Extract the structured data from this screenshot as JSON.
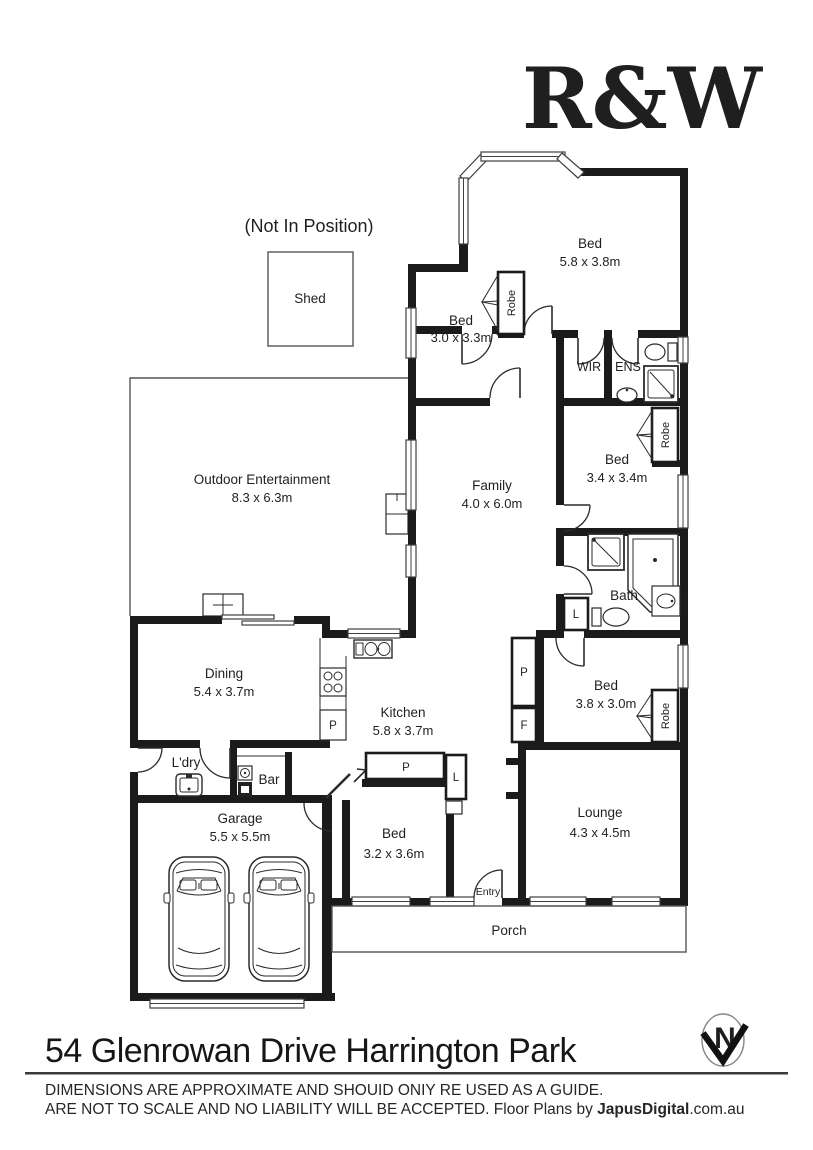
{
  "logo": {
    "text": "R&W",
    "color": "#E4032E"
  },
  "notes": {
    "not_in_position": "(Not In Position)"
  },
  "rooms": {
    "shed": {
      "name": "Shed"
    },
    "bed_master": {
      "name": "Bed",
      "dims": "5.8 x 3.8m"
    },
    "bed2": {
      "name": "Bed",
      "dims": "3.0 x 3.3m"
    },
    "bed3": {
      "name": "Bed",
      "dims": "3.4 x 3.4m"
    },
    "bed4": {
      "name": "Bed",
      "dims": "3.8 x 3.0m"
    },
    "bed5": {
      "name": "Bed",
      "dims": "3.2 x 3.6m"
    },
    "family": {
      "name": "Family",
      "dims": "4.0 x 6.0m"
    },
    "outdoor": {
      "name": "Outdoor Entertainment",
      "dims": "8.3 x 6.3m"
    },
    "dining": {
      "name": "Dining",
      "dims": "5.4 x 3.7m"
    },
    "kitchen": {
      "name": "Kitchen",
      "dims": "5.8 x 3.7m"
    },
    "lounge": {
      "name": "Lounge",
      "dims": "4.3 x 4.5m"
    },
    "garage": {
      "name": "Garage",
      "dims": "5.5 x 5.5m"
    },
    "laundry": {
      "name": "L'dry"
    },
    "bar": {
      "name": "Bar"
    },
    "bath": {
      "name": "Bath"
    },
    "wir": {
      "name": "WIR"
    },
    "ens": {
      "name": "ENS"
    },
    "entry": {
      "name": "Entry"
    },
    "porch": {
      "name": "Porch"
    }
  },
  "tags": {
    "robe": "Robe",
    "pantry": "P",
    "fridge": "F",
    "linen": "L",
    "north": "N"
  },
  "footer": {
    "address": "54 Glenrowan Drive Harrington Park",
    "disclaimer_line1": "DIMENSIONS ARE APPROXIMATE AND SHOUID ONIY RE USED AS A GUIDE.",
    "disclaimer_line2": "ARE NOT TO SCALE AND NO LIABILITY WILL BE ACCEPTED. Floor Plans by ",
    "brand": "JapusDigital",
    "brand_suffix": ".com.au"
  }
}
